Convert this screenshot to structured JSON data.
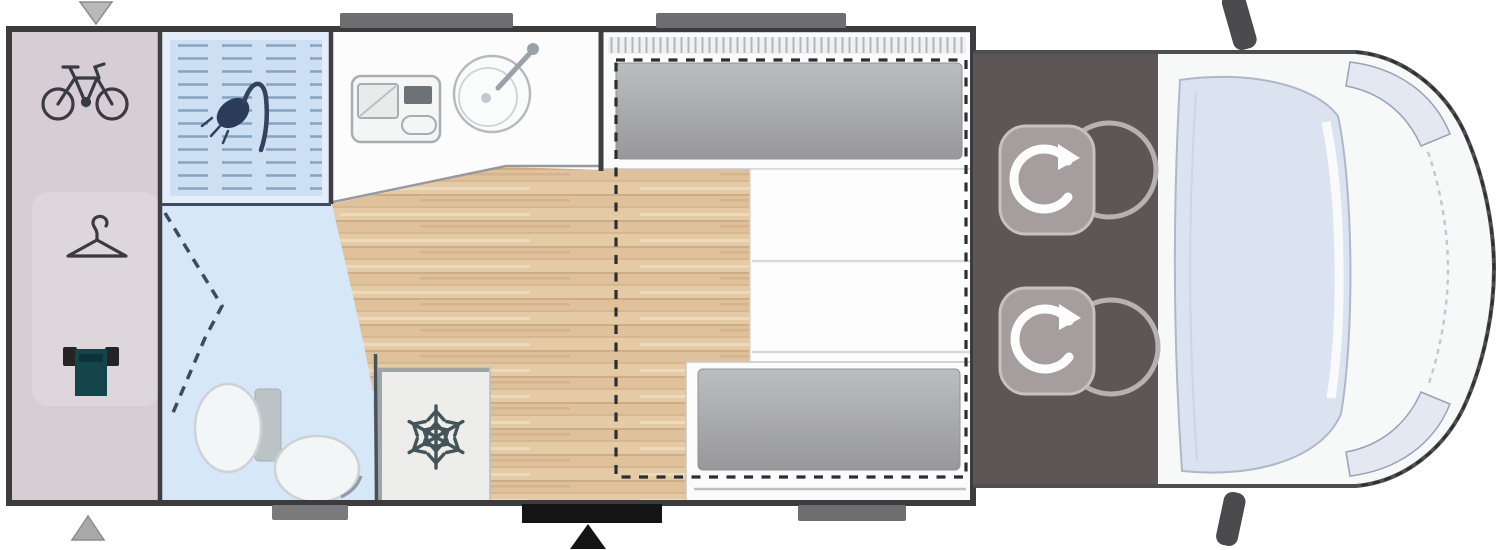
{
  "image": {
    "type": "motorhome-floorplan-top-view",
    "width_px": 1500,
    "height_px": 550,
    "orientation": "cab-on-right, rear-garage-on-left"
  },
  "colors": {
    "background": "#ffffff",
    "wall": "#3c3c3e",
    "garage": "#d7cdd5",
    "garage_inner": "#ddd6db",
    "shower": "#cde0f3",
    "shower_hatch_line": "#86a3c0",
    "bathroom": "#d6e7f7",
    "wood_floor": "#dfc19c",
    "kitchen_counter": "#fcfcfc",
    "mattress_gray": "#a8a8aa",
    "bed_white": "#fdfdfe",
    "dashed_bed_outline": "#2e2e32",
    "fridge": "#ededec",
    "boiler_teal": "#14454b",
    "cab_floor": "#5e5556",
    "seat_gray": "#a59d9e",
    "van_body": "#f7f8f8",
    "windshield": "#dce3f0",
    "headlight": "#e3e8f2",
    "mirror": "#4b4b4d",
    "window_marker": "#6e6e70",
    "entry_door_marker": "#141414"
  },
  "zones": {
    "garage": {
      "label_semantic": "rear-garage",
      "icons": [
        "bicycle-icon",
        "hanger-icon",
        "boiler-icon"
      ]
    },
    "shower": {
      "label_semantic": "shower-cubicle",
      "icons": [
        "shower-head-icon"
      ]
    },
    "bathroom": {
      "label_semantic": "washroom",
      "icons": [
        "toilet-icon",
        "folding-door-dashes"
      ]
    },
    "kitchen": {
      "label_semantic": "kitchen-counter",
      "icons": [
        "cooktop-icon",
        "sink-icon"
      ]
    },
    "fridge": {
      "label_semantic": "fridge-unit",
      "icons": [
        "snowflake-icon"
      ]
    },
    "lounge": {
      "label_semantic": "wood-floor-aisle",
      "icons": []
    },
    "beds": {
      "label_semantic": "rear-sleeping-area",
      "items": [
        "drop-down-top-bunk",
        "fixed-double-bed",
        "drop-down-bottom-bunk"
      ],
      "outline_style": "dashed"
    },
    "cab": {
      "label_semantic": "driver-cab",
      "icons": [
        "swivel-seat-icon",
        "swivel-seat-icon"
      ]
    },
    "van_front": {
      "label_semantic": "vehicle-nose",
      "icons": [
        "windshield",
        "headlight-icon",
        "headlight-icon",
        "side-mirror-icon",
        "side-mirror-icon"
      ]
    }
  },
  "markers": {
    "top_window_count": 2,
    "bottom_window_count": 2,
    "entry_door_count": 1,
    "arrows": [
      "down-arrow-top-left",
      "up-arrow-bottom-left",
      "up-arrow-entry-door"
    ]
  }
}
